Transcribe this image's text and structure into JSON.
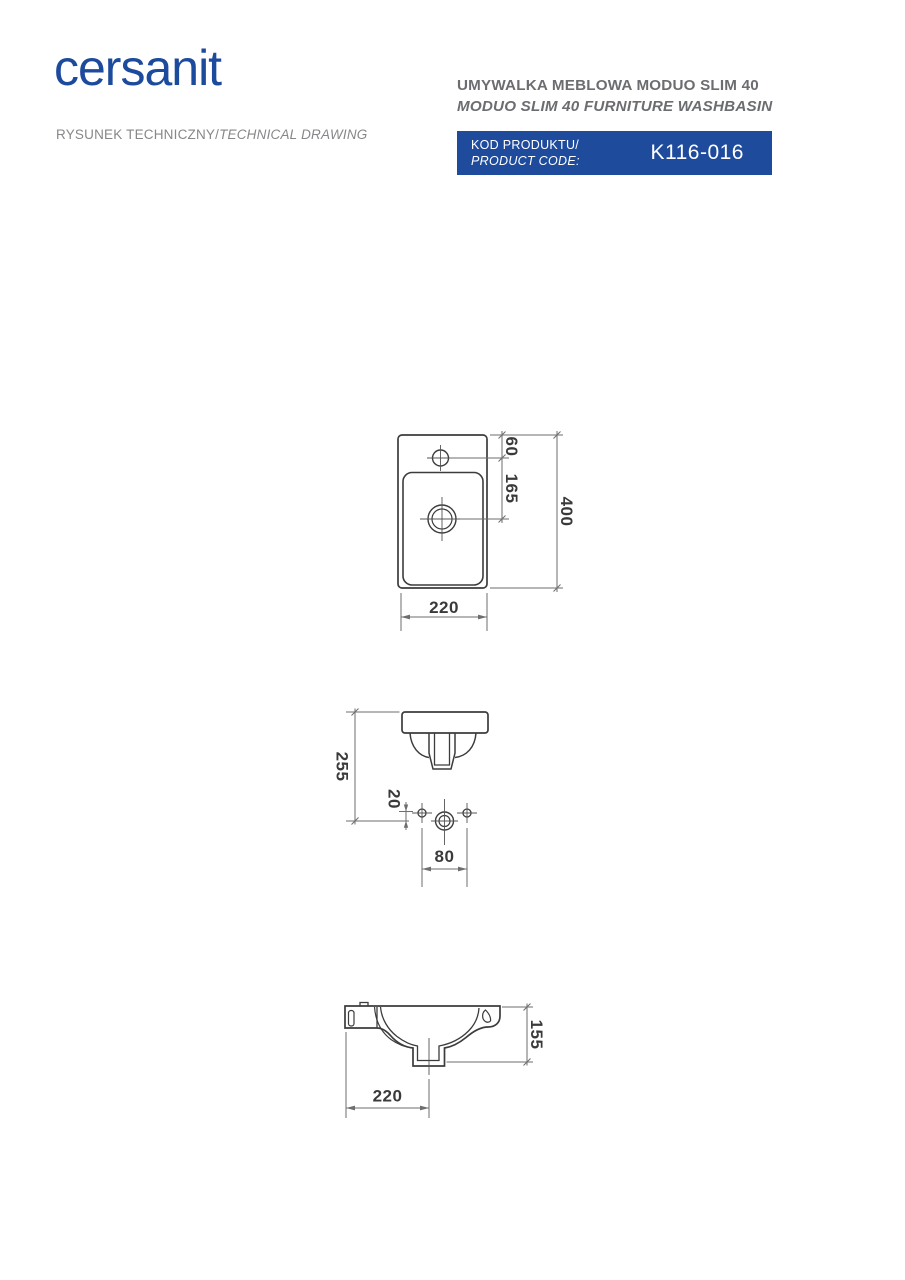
{
  "header": {
    "logo": "cersanit",
    "subtitle_pl": "RYSUNEK TECHNICZNY/",
    "subtitle_en": "TECHNICAL DRAWING",
    "title_pl": "UMYWALKA MEBLOWA MODUO SLIM 40",
    "title_en": "MODUO SLIM 40 FURNITURE WASHBASIN",
    "code_label_pl": "KOD PRODUKTU/",
    "code_label_en": "PRODUCT CODE:",
    "code_value": "K116-016",
    "brand_color": "#1c4a9c",
    "code_box_color": "#1e4b9c"
  },
  "drawings": {
    "top_view": {
      "dims": {
        "tap_offset": "60",
        "drain_offset": "165",
        "length": "400",
        "depth": "220"
      }
    },
    "front_view": {
      "dims": {
        "height": "255",
        "hole_offset": "20",
        "hole_spacing": "80"
      }
    },
    "section_view": {
      "dims": {
        "height": "155",
        "drain_position": "220"
      }
    }
  }
}
